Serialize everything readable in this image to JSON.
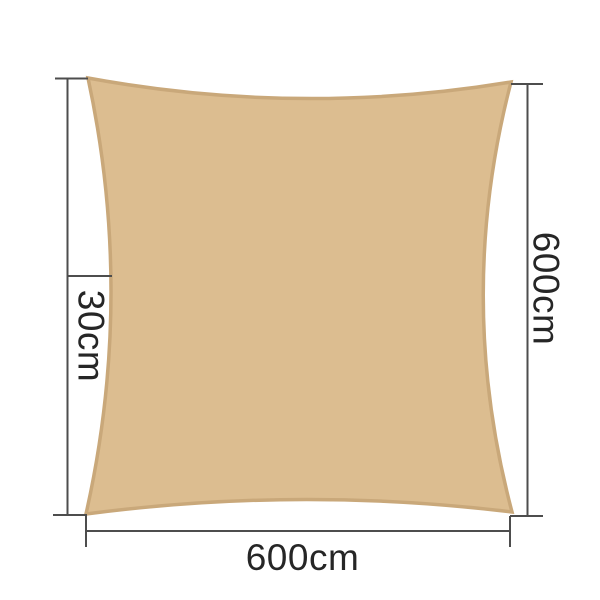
{
  "diagram": {
    "labels": {
      "sag_depth": "30cm",
      "side_height": "600cm",
      "bottom_width": "600cm"
    },
    "colors": {
      "sail_fill": "#dcbd90",
      "sail_edge": "#c9a87a",
      "dimension_line": "#4d4d4d",
      "label_text": "#262626",
      "background": "#ffffff"
    }
  }
}
